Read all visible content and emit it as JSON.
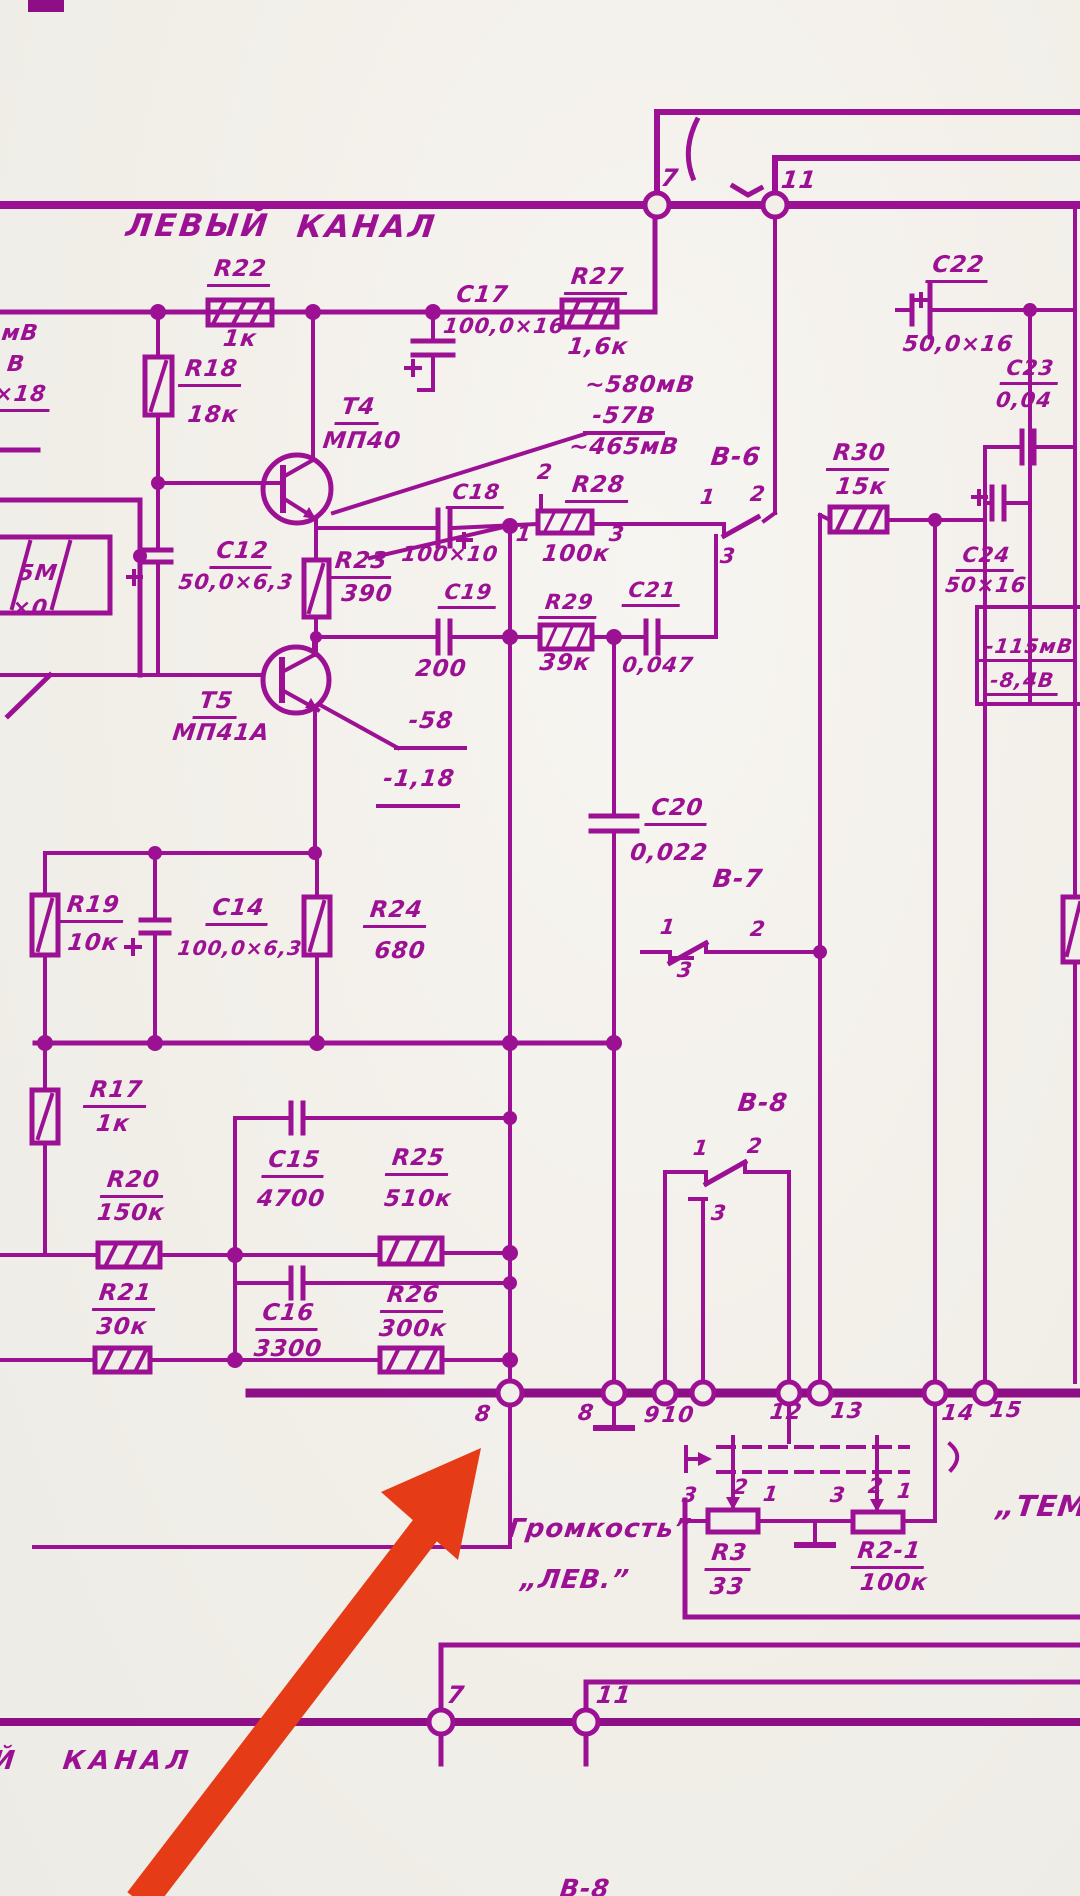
{
  "title": {
    "left": "ЛЕВЫЙ",
    "right": "КАНАЛ"
  },
  "volume": {
    "label": "Громкость”",
    "channel": "„ЛЕВ.”"
  },
  "tone": {
    "label": "„ТЕМ"
  },
  "bottom": {
    "channel": "КАНАЛ",
    "channel_prefix": "Й",
    "switch_label": "В-8"
  },
  "colors": {
    "ink": "#9c1193",
    "ink_thick": "#8d0e85",
    "paper": "#f2efe9",
    "arrow_red": "#e63b17"
  },
  "labels": [
    {
      "id": "frag-mv",
      "text": "мВ",
      "x": 20,
      "y": 323,
      "fs": 22
    },
    {
      "id": "frag-v",
      "text": "В",
      "x": 16,
      "y": 354,
      "fs": 22
    },
    {
      "id": "frag-x18",
      "text": "×18",
      "x": 20,
      "y": 384,
      "fs": 22,
      "ul": true
    },
    {
      "id": "frag-5m",
      "text": "5М",
      "x": 38,
      "y": 563,
      "fs": 22
    },
    {
      "id": "frag-x0",
      "text": "×0",
      "x": 30,
      "y": 598,
      "fs": 22
    },
    {
      "id": "top-node-7",
      "text": "7",
      "x": 670,
      "y": 166,
      "fs": 24
    },
    {
      "id": "top-node-11",
      "text": "11",
      "x": 799,
      "y": 168,
      "fs": 24
    },
    {
      "id": "r22-ref",
      "text": "R22",
      "x": 240,
      "y": 258,
      "ul": true
    },
    {
      "id": "r22-val",
      "text": "1к",
      "x": 240,
      "y": 328
    },
    {
      "id": "r18-ref",
      "text": "R18",
      "x": 211,
      "y": 358,
      "ul": true
    },
    {
      "id": "r18-val",
      "text": "18к",
      "x": 213,
      "y": 404
    },
    {
      "id": "c17-ref",
      "text": "С17",
      "x": 482,
      "y": 284,
      "ul": true
    },
    {
      "id": "c17-val",
      "text": "100,0×16",
      "x": 504,
      "y": 316,
      "fs": 21
    },
    {
      "id": "r27-ref",
      "text": "R27",
      "x": 597,
      "y": 266,
      "ul": true
    },
    {
      "id": "r27-val",
      "text": "1,6к",
      "x": 598,
      "y": 336
    },
    {
      "id": "c22-ref",
      "text": "С22",
      "x": 958,
      "y": 254,
      "ul": true
    },
    {
      "id": "c22-val",
      "text": "50,0×16",
      "x": 958,
      "y": 334,
      "fs": 22
    },
    {
      "id": "c23-ref",
      "text": "С23",
      "x": 1030,
      "y": 358,
      "ul": true,
      "fs": 21
    },
    {
      "id": "c23-val",
      "text": "0,04",
      "x": 1024,
      "y": 390,
      "fs": 21
    },
    {
      "id": "t4-ref",
      "text": "Т4",
      "x": 358,
      "y": 396,
      "ul": true
    },
    {
      "id": "t4-val",
      "text": "МП40",
      "x": 362,
      "y": 430
    },
    {
      "id": "v580",
      "text": "~580мВ",
      "x": 640,
      "y": 374
    },
    {
      "id": "v57",
      "text": "-57В",
      "x": 624,
      "y": 405
    },
    {
      "id": "v465",
      "text": "~465мВ",
      "x": 624,
      "y": 436
    },
    {
      "id": "b6-label",
      "text": "В-6",
      "x": 736,
      "y": 444,
      "fs": 25
    },
    {
      "id": "b6-pin1",
      "text": "1",
      "x": 708,
      "y": 487,
      "fs": 21
    },
    {
      "id": "b6-pin2",
      "text": "2",
      "x": 758,
      "y": 484,
      "fs": 21
    },
    {
      "id": "b6-pin3",
      "text": "3",
      "x": 728,
      "y": 546,
      "fs": 21
    },
    {
      "id": "r28-pin2",
      "text": "2",
      "x": 545,
      "y": 462,
      "fs": 21
    },
    {
      "id": "r28-ref",
      "text": "R28",
      "x": 598,
      "y": 474,
      "ul": true
    },
    {
      "id": "r28-pin1",
      "text": "1",
      "x": 524,
      "y": 524,
      "fs": 21
    },
    {
      "id": "r28-pin3",
      "text": "3",
      "x": 617,
      "y": 524,
      "fs": 21
    },
    {
      "id": "r28-val",
      "text": "100к",
      "x": 576,
      "y": 543
    },
    {
      "id": "r30-ref",
      "text": "R30",
      "x": 859,
      "y": 442,
      "ul": true
    },
    {
      "id": "r30-val",
      "text": "15к",
      "x": 861,
      "y": 476
    },
    {
      "id": "c18-ref",
      "text": "С18",
      "x": 476,
      "y": 482,
      "ul": true,
      "fs": 21
    },
    {
      "id": "c18-val",
      "text": "100×10",
      "x": 450,
      "y": 544,
      "fs": 21
    },
    {
      "id": "c12-ref",
      "text": "С12",
      "x": 242,
      "y": 540,
      "ul": true
    },
    {
      "id": "c12-val",
      "text": "50,0×6,3",
      "x": 236,
      "y": 572,
      "fs": 21
    },
    {
      "id": "r23-ref",
      "text": "R23",
      "x": 361,
      "y": 550,
      "ul": true
    },
    {
      "id": "r23-val",
      "text": "390",
      "x": 367,
      "y": 583
    },
    {
      "id": "c19-ref",
      "text": "С19",
      "x": 468,
      "y": 582,
      "ul": true,
      "fs": 21
    },
    {
      "id": "c19-val",
      "text": "200",
      "x": 441,
      "y": 658
    },
    {
      "id": "r29-ref",
      "text": "R29",
      "x": 569,
      "y": 592,
      "ul": true,
      "fs": 21
    },
    {
      "id": "r29-val",
      "text": "39к",
      "x": 565,
      "y": 652
    },
    {
      "id": "c21-ref",
      "text": "С21",
      "x": 652,
      "y": 580,
      "ul": true,
      "fs": 21
    },
    {
      "id": "c21-val",
      "text": "0,047",
      "x": 658,
      "y": 655,
      "fs": 21
    },
    {
      "id": "c24-ref",
      "text": "С24",
      "x": 986,
      "y": 545,
      "ul": true,
      "fs": 21
    },
    {
      "id": "c24-val",
      "text": "50×16",
      "x": 986,
      "y": 575,
      "fs": 21
    },
    {
      "id": "vm115",
      "text": "-115мВ",
      "x": 1029,
      "y": 636,
      "fs": 20,
      "ul": true
    },
    {
      "id": "vm84",
      "text": "-8,4В",
      "x": 1022,
      "y": 670,
      "fs": 20,
      "ul": true
    },
    {
      "id": "t5-ref",
      "text": "Т5",
      "x": 216,
      "y": 690,
      "ul": true
    },
    {
      "id": "t5-val",
      "text": "МП41А",
      "x": 221,
      "y": 722
    },
    {
      "id": "v-58",
      "text": "-58",
      "x": 431,
      "y": 710
    },
    {
      "id": "v-118",
      "text": "-1,18",
      "x": 419,
      "y": 768
    },
    {
      "id": "c20-ref",
      "text": "С20",
      "x": 677,
      "y": 797,
      "ul": true
    },
    {
      "id": "c20-val",
      "text": "0,022",
      "x": 669,
      "y": 842
    },
    {
      "id": "b7-label",
      "text": "В-7",
      "x": 738,
      "y": 866,
      "fs": 25
    },
    {
      "id": "b7-pin1",
      "text": "1",
      "x": 668,
      "y": 917,
      "fs": 21
    },
    {
      "id": "b7-pin2",
      "text": "2",
      "x": 758,
      "y": 919,
      "fs": 21
    },
    {
      "id": "b7-pin3",
      "text": "3",
      "x": 685,
      "y": 960,
      "fs": 21
    },
    {
      "id": "r19-ref",
      "text": "R19",
      "x": 93,
      "y": 894,
      "ul": true
    },
    {
      "id": "r19-val",
      "text": "10к",
      "x": 93,
      "y": 932
    },
    {
      "id": "c14-ref",
      "text": "С14",
      "x": 238,
      "y": 897,
      "ul": true
    },
    {
      "id": "c14-val",
      "text": "100,0×6,3",
      "x": 240,
      "y": 938,
      "fs": 20
    },
    {
      "id": "r24-ref",
      "text": "R24",
      "x": 396,
      "y": 899,
      "ul": true
    },
    {
      "id": "r24-val",
      "text": "680",
      "x": 400,
      "y": 940
    },
    {
      "id": "r17-ref",
      "text": "R17",
      "x": 116,
      "y": 1079,
      "ul": true
    },
    {
      "id": "r17-val",
      "text": "1к",
      "x": 113,
      "y": 1113
    },
    {
      "id": "r20-ref",
      "text": "R20",
      "x": 133,
      "y": 1169,
      "ul": true
    },
    {
      "id": "r20-val",
      "text": "150к",
      "x": 131,
      "y": 1202
    },
    {
      "id": "c15-ref",
      "text": "С15",
      "x": 294,
      "y": 1149,
      "ul": true
    },
    {
      "id": "c15-val",
      "text": "4700",
      "x": 291,
      "y": 1188
    },
    {
      "id": "r25-ref",
      "text": "R25",
      "x": 418,
      "y": 1147,
      "ul": true
    },
    {
      "id": "r25-val",
      "text": "510к",
      "x": 418,
      "y": 1188
    },
    {
      "id": "r21-ref",
      "text": "R21",
      "x": 125,
      "y": 1282,
      "ul": true
    },
    {
      "id": "r21-val",
      "text": "30к",
      "x": 122,
      "y": 1316
    },
    {
      "id": "c16-ref",
      "text": "С16",
      "x": 288,
      "y": 1302,
      "ul": true
    },
    {
      "id": "c16-val",
      "text": "3300",
      "x": 288,
      "y": 1338
    },
    {
      "id": "r26-ref",
      "text": "R26",
      "x": 413,
      "y": 1284,
      "ul": true
    },
    {
      "id": "r26-val",
      "text": "300к",
      "x": 413,
      "y": 1318
    },
    {
      "id": "b8-label",
      "text": "В-8",
      "x": 763,
      "y": 1090,
      "fs": 25
    },
    {
      "id": "b8-pin1",
      "text": "1",
      "x": 701,
      "y": 1138,
      "fs": 21
    },
    {
      "id": "b8-pin2",
      "text": "2",
      "x": 755,
      "y": 1136,
      "fs": 21
    },
    {
      "id": "b8-pin3",
      "text": "3",
      "x": 719,
      "y": 1203,
      "fs": 21
    },
    {
      "id": "bus-node-8",
      "text": "8",
      "x": 483,
      "y": 1404,
      "fs": 22
    },
    {
      "id": "bus-node-8gnd",
      "text": "8",
      "x": 586,
      "y": 1403,
      "fs": 22
    },
    {
      "id": "bus-node-9",
      "text": "9",
      "x": 652,
      "y": 1405,
      "fs": 22
    },
    {
      "id": "bus-node-10",
      "text": "10",
      "x": 678,
      "y": 1405,
      "fs": 22
    },
    {
      "id": "bus-node-12",
      "text": "12",
      "x": 786,
      "y": 1402,
      "fs": 22
    },
    {
      "id": "bus-node-13",
      "text": "13",
      "x": 847,
      "y": 1401,
      "fs": 22
    },
    {
      "id": "bus-node-14",
      "text": "14",
      "x": 958,
      "y": 1403,
      "fs": 22
    },
    {
      "id": "bus-node-15",
      "text": "15",
      "x": 1006,
      "y": 1400,
      "fs": 22
    },
    {
      "id": "pot1-pin3",
      "text": "3",
      "x": 690,
      "y": 1485,
      "fs": 21
    },
    {
      "id": "pot1-pin2",
      "text": "2",
      "x": 741,
      "y": 1477,
      "fs": 21
    },
    {
      "id": "pot1-pin1",
      "text": "1",
      "x": 771,
      "y": 1484,
      "fs": 21
    },
    {
      "id": "pot2-pin3",
      "text": "3",
      "x": 838,
      "y": 1485,
      "fs": 21
    },
    {
      "id": "pot2-pin2",
      "text": "2",
      "x": 876,
      "y": 1476,
      "fs": 21
    },
    {
      "id": "pot2-pin1",
      "text": "1",
      "x": 905,
      "y": 1481,
      "fs": 21
    },
    {
      "id": "r3-ref",
      "text": "R3",
      "x": 729,
      "y": 1542,
      "ul": true
    },
    {
      "id": "r3-val",
      "text": "33",
      "x": 727,
      "y": 1576
    },
    {
      "id": "r2-1-ref",
      "text": "R2-1",
      "x": 889,
      "y": 1540,
      "ul": true
    },
    {
      "id": "r2-1-val",
      "text": "100к",
      "x": 894,
      "y": 1572
    },
    {
      "id": "bot-node-7",
      "text": "7",
      "x": 456,
      "y": 1683,
      "fs": 24
    },
    {
      "id": "bot-node-11",
      "text": "11",
      "x": 614,
      "y": 1683,
      "fs": 24
    }
  ]
}
